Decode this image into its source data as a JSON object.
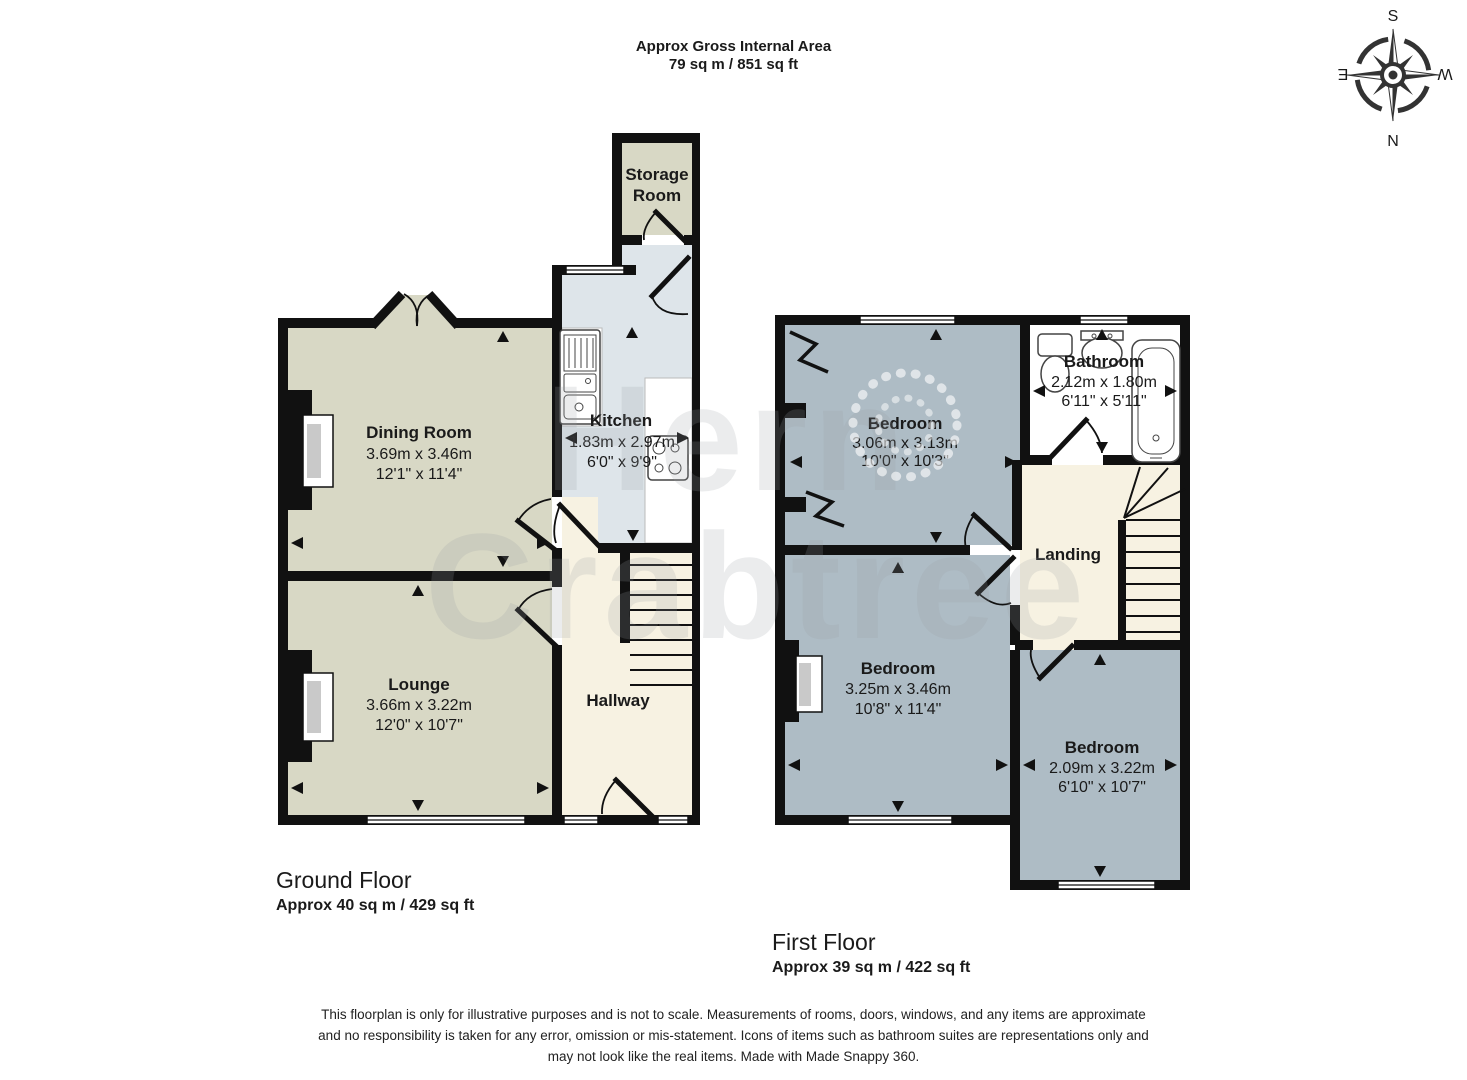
{
  "header": {
    "line1": "Approx Gross Internal Area",
    "line2": "79 sq m / 851 sq ft"
  },
  "compass": {
    "top": "S",
    "bottom": "N",
    "left": "E",
    "right": "W"
  },
  "watermark": {
    "line1": "Hern",
    "line2": "Crabtree"
  },
  "colors": {
    "wall": "#111111",
    "room_olive": "#d8d8c5",
    "room_kitchen_blue": "#dee5ea",
    "room_cream": "#f7f2e2",
    "room_bedroom_blue": "#aebcc5",
    "room_bathroom_white": "#ffffff"
  },
  "ground_floor": {
    "title": "Ground Floor",
    "area": "Approx 40 sq m / 429 sq ft",
    "storage": {
      "line1": "Storage",
      "line2": "Room"
    },
    "dining": {
      "name": "Dining Room",
      "metric": "3.69m x 3.46m",
      "imperial": "12'1\" x 11'4\""
    },
    "kitchen": {
      "name": "Kitchen",
      "metric": "1.83m x 2.97m",
      "imperial": "6'0\" x 9'9\""
    },
    "lounge": {
      "name": "Lounge",
      "metric": "3.66m x 3.22m",
      "imperial": "12'0\" x 10'7\""
    },
    "hallway": {
      "name": "Hallway"
    }
  },
  "first_floor": {
    "title": "First Floor",
    "area": "Approx 39 sq m / 422 sq ft",
    "bedroom1": {
      "name": "Bedroom",
      "metric": "3.06m x 3.13m",
      "imperial": "10'0\" x 10'3\""
    },
    "bathroom": {
      "name": "Bathroom",
      "metric": "2.12m x 1.80m",
      "imperial": "6'11\" x 5'11\""
    },
    "landing": {
      "name": "Landing"
    },
    "bedroom2": {
      "name": "Bedroom",
      "metric": "3.25m x 3.46m",
      "imperial": "10'8\" x 11'4\""
    },
    "bedroom3": {
      "name": "Bedroom",
      "metric": "2.09m x 3.22m",
      "imperial": "6'10\" x 10'7\""
    }
  },
  "disclaimer": {
    "line1": "This floorplan is only for illustrative purposes and is not to scale. Measurements of rooms, doors, windows, and any items are approximate",
    "line2": "and no responsibility is taken for any error, omission or mis-statement. Icons of items such as bathroom suites are representations only and",
    "line3": "may not look like the real items. Made with Made Snappy 360."
  }
}
